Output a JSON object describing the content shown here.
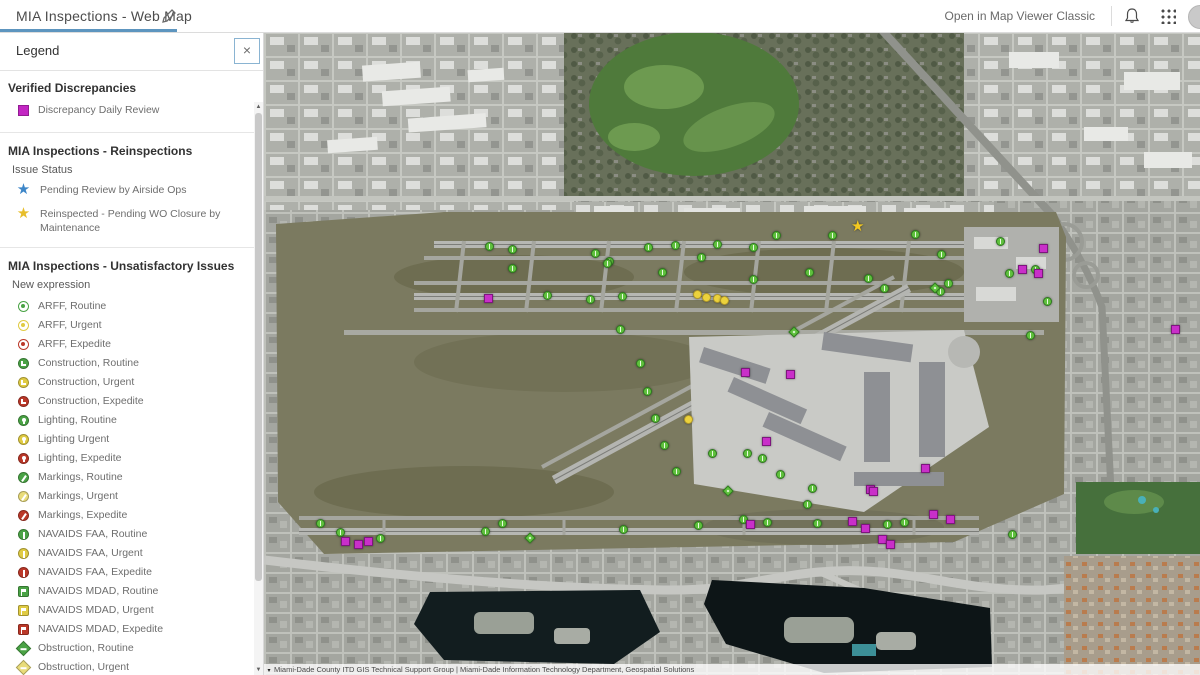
{
  "header": {
    "title": "MIA Inspections - Web Map",
    "open_classic_label": "Open in Map Viewer Classic",
    "accent_color": "#5d95bf"
  },
  "legend": {
    "title": "Legend",
    "close_label": "×",
    "sections": [
      {
        "header": "Verified Discrepancies",
        "sublabel": null,
        "items": [
          {
            "kind": "square",
            "color": "#c326c3",
            "label": "Discrepancy Daily Review"
          }
        ]
      },
      {
        "header": "MIA Inspections - Reinspections",
        "sublabel": "Issue Status",
        "items": [
          {
            "kind": "star",
            "color": "#3d86c8",
            "label": "Pending Review by Airside Ops"
          },
          {
            "kind": "star",
            "color": "#e7be2b",
            "label": "Reinspected - Pending WO Closure by Maintenance"
          }
        ]
      },
      {
        "header": "MIA Inspections - Unsatisfactory Issues",
        "sublabel": "New expression",
        "items": [
          {
            "kind": "arff",
            "color": "#4aa345",
            "label": "ARFF, Routine"
          },
          {
            "kind": "arff",
            "color": "#e0cb43",
            "label": "ARFF, Urgent"
          },
          {
            "kind": "arff",
            "color": "#bb3829",
            "label": "ARFF, Expedite"
          },
          {
            "kind": "construction",
            "color": "#4aa345",
            "label": "Construction, Routine"
          },
          {
            "kind": "construction",
            "color": "#e0cb43",
            "label": "Construction, Urgent"
          },
          {
            "kind": "construction",
            "color": "#bb3829",
            "label": "Construction, Expedite"
          },
          {
            "kind": "lighting",
            "color": "#4aa345",
            "label": "Lighting, Routine"
          },
          {
            "kind": "lighting",
            "color": "#e0cb43",
            "label": "Lighting Urgent"
          },
          {
            "kind": "lighting",
            "color": "#bb3829",
            "label": "Lighting, Expedite"
          },
          {
            "kind": "markings",
            "color": "#4aa345",
            "label": "Markings, Routine"
          },
          {
            "kind": "markings",
            "color": "#e9dc7a",
            "label": "Markings, Urgent"
          },
          {
            "kind": "markings",
            "color": "#bb3829",
            "label": "Markings, Expedite"
          },
          {
            "kind": "navfaa",
            "color": "#4aa345",
            "label": "NAVAIDS FAA, Routine"
          },
          {
            "kind": "navfaa",
            "color": "#e0cb43",
            "label": "NAVAIDS FAA, Urgent"
          },
          {
            "kind": "navfaa",
            "color": "#bb3829",
            "label": "NAVAIDS FAA, Expedite"
          },
          {
            "kind": "navmdad",
            "color": "#4aa345",
            "label": "NAVAIDS MDAD, Routine"
          },
          {
            "kind": "navmdad",
            "color": "#e0cb43",
            "label": "NAVAIDS MDAD, Urgent"
          },
          {
            "kind": "navmdad",
            "color": "#bb3829",
            "label": "NAVAIDS MDAD, Expedite"
          },
          {
            "kind": "obstruction",
            "color": "#4aa345",
            "label": "Obstruction, Routine"
          },
          {
            "kind": "obstruction",
            "color": "#e9dc7a",
            "label": "Obstruction, Urgent"
          },
          {
            "kind": "obstruction",
            "color": "#bb3829",
            "label": "Obstruction, Expedite"
          }
        ]
      }
    ]
  },
  "map": {
    "attribution": "Miami-Dade County ITD GIS Technical Support Group | Miami-Dade Information Technology Department, Geospatial Solutions",
    "marker_colors": {
      "green": "#5fc13d",
      "magenta": "#c92fc9",
      "yellow": "#ecd23c",
      "star": "#f2c821"
    },
    "markers": {
      "green": [
        [
          225,
          214
        ],
        [
          248,
          217
        ],
        [
          331,
          221
        ],
        [
          345,
          229
        ],
        [
          384,
          215
        ],
        [
          411,
          213
        ],
        [
          437,
          225
        ],
        [
          453,
          212
        ],
        [
          489,
          215
        ],
        [
          512,
          203
        ],
        [
          568,
          203
        ],
        [
          651,
          202
        ],
        [
          677,
          222
        ],
        [
          736,
          209
        ],
        [
          745,
          241
        ],
        [
          771,
          237
        ],
        [
          783,
          269
        ],
        [
          248,
          236
        ],
        [
          343,
          231
        ],
        [
          398,
          240
        ],
        [
          489,
          247
        ],
        [
          545,
          240
        ],
        [
          604,
          246
        ],
        [
          684,
          251
        ],
        [
          283,
          263
        ],
        [
          326,
          267
        ],
        [
          358,
          264
        ],
        [
          620,
          256
        ],
        [
          676,
          259
        ],
        [
          356,
          297
        ],
        [
          376,
          331
        ],
        [
          383,
          359
        ],
        [
          391,
          386
        ],
        [
          400,
          413
        ],
        [
          412,
          439
        ],
        [
          448,
          421
        ],
        [
          483,
          421
        ],
        [
          498,
          426
        ],
        [
          516,
          442
        ],
        [
          548,
          456
        ],
        [
          56,
          491
        ],
        [
          76,
          500
        ],
        [
          116,
          506
        ],
        [
          221,
          499
        ],
        [
          238,
          491
        ],
        [
          359,
          497
        ],
        [
          434,
          493
        ],
        [
          479,
          487
        ],
        [
          543,
          472
        ],
        [
          553,
          491
        ],
        [
          748,
          502
        ],
        [
          766,
          303
        ],
        [
          503,
          490
        ],
        [
          623,
          492
        ],
        [
          640,
          490
        ]
      ],
      "green_diamond": [
        [
          671,
          256
        ],
        [
          266,
          506
        ],
        [
          464,
          459
        ],
        [
          530,
          300
        ]
      ],
      "magenta": [
        [
          224,
          266
        ],
        [
          481,
          340
        ],
        [
          526,
          342
        ],
        [
          502,
          409
        ],
        [
          661,
          436
        ],
        [
          606,
          457
        ],
        [
          758,
          237
        ],
        [
          774,
          241
        ],
        [
          779,
          216
        ],
        [
          486,
          492
        ],
        [
          588,
          489
        ],
        [
          601,
          496
        ],
        [
          618,
          507
        ],
        [
          626,
          512
        ],
        [
          669,
          482
        ],
        [
          686,
          487
        ],
        [
          81,
          509
        ],
        [
          94,
          512
        ],
        [
          104,
          509
        ],
        [
          911,
          297
        ],
        [
          609,
          459
        ]
      ],
      "yellow": [
        [
          433,
          262
        ],
        [
          442,
          265
        ],
        [
          453,
          266
        ],
        [
          460,
          268
        ],
        [
          424,
          387
        ]
      ],
      "star": [
        [
          594,
          196
        ]
      ]
    }
  }
}
